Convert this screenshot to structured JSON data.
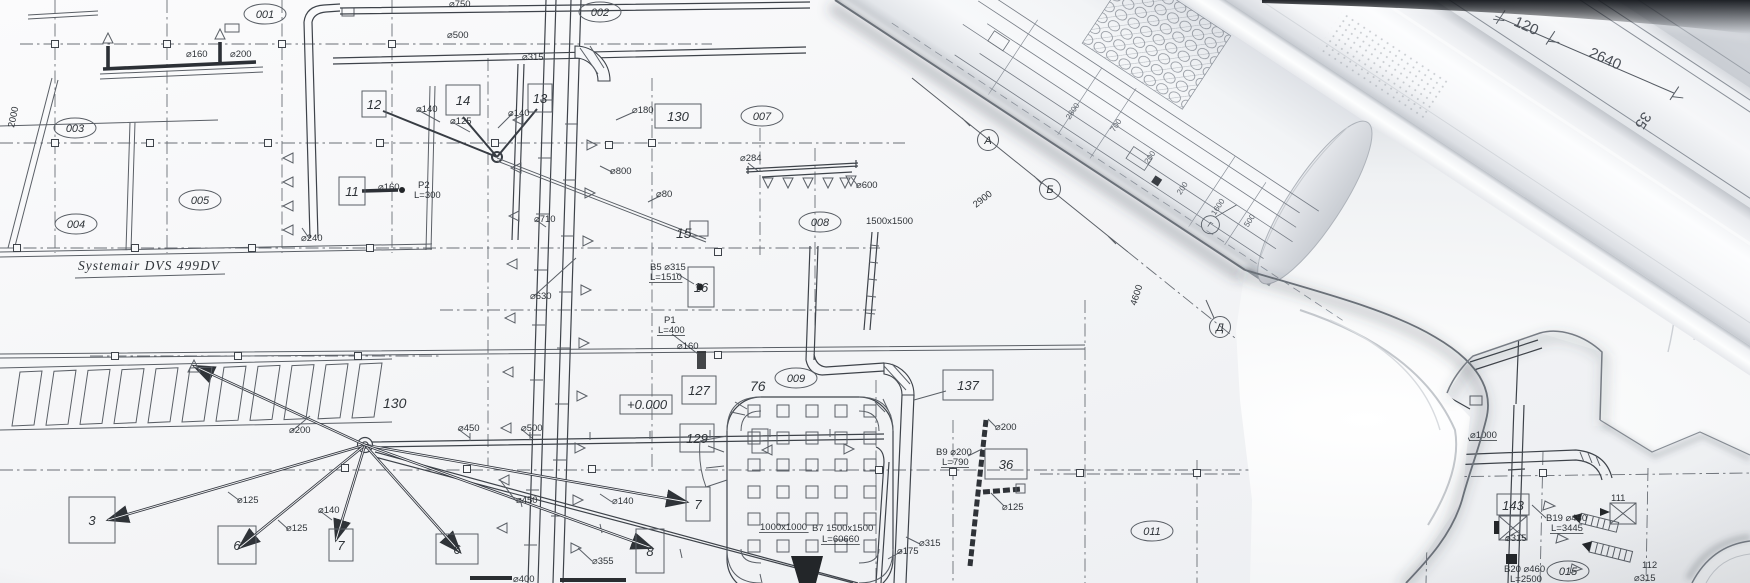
{
  "plan": {
    "title": "Systemair DVS 499DV",
    "elevation": "+0.000",
    "room_tags": [
      {
        "t": "001",
        "x": 265,
        "y": 14
      },
      {
        "t": "002",
        "x": 600,
        "y": 12
      },
      {
        "t": "003",
        "x": 75,
        "y": 128
      },
      {
        "t": "005",
        "x": 200,
        "y": 200
      },
      {
        "t": "004",
        "x": 76,
        "y": 224
      },
      {
        "t": "007",
        "x": 762,
        "y": 116
      },
      {
        "t": "008",
        "x": 820,
        "y": 222
      },
      {
        "t": "009",
        "x": 796,
        "y": 378
      },
      {
        "t": "011",
        "x": 1152,
        "y": 531
      }
    ],
    "equipment_boxes": [
      {
        "t": "12",
        "x": 374,
        "y": 104,
        "w": 24,
        "h": 26
      },
      {
        "t": "11",
        "x": 352,
        "y": 191,
        "w": 26,
        "h": 28
      },
      {
        "t": "14",
        "x": 463,
        "y": 100,
        "w": 34,
        "h": 30
      },
      {
        "t": "13",
        "x": 540,
        "y": 98,
        "w": 24,
        "h": 28
      },
      {
        "t": "130",
        "x": 678,
        "y": 116,
        "w": 46,
        "h": 24
      },
      {
        "t": "16",
        "x": 701,
        "y": 287,
        "w": 26,
        "h": 40
      },
      {
        "t": "127",
        "x": 699,
        "y": 390,
        "w": 34,
        "h": 28
      },
      {
        "t": "129",
        "x": 697,
        "y": 438,
        "w": 34,
        "h": 28
      },
      {
        "t": "137",
        "x": 968,
        "y": 385,
        "w": 50,
        "h": 30
      },
      {
        "t": "36",
        "x": 1006,
        "y": 464,
        "w": 42,
        "h": 30
      },
      {
        "t": "7",
        "x": 698,
        "y": 504,
        "w": 24,
        "h": 34
      },
      {
        "t": "3",
        "x": 92,
        "y": 520,
        "w": 46,
        "h": 46
      },
      {
        "t": "6",
        "x": 237,
        "y": 545,
        "w": 38,
        "h": 38
      },
      {
        "t": "7",
        "x": 341,
        "y": 545,
        "w": 24,
        "h": 32
      },
      {
        "t": "6",
        "x": 457,
        "y": 549,
        "w": 42,
        "h": 30
      },
      {
        "t": "8",
        "x": 650,
        "y": 551,
        "w": 28,
        "h": 44
      }
    ],
    "plain_tags": [
      {
        "t": "15",
        "x": 676,
        "y": 238
      },
      {
        "t": "76",
        "x": 750,
        "y": 391
      },
      {
        "t": "130",
        "x": 383,
        "y": 408
      }
    ],
    "dim_labels": [
      {
        "t": "⌀160",
        "x": 186,
        "y": 57
      },
      {
        "t": "⌀200",
        "x": 230,
        "y": 57
      },
      {
        "t": "⌀140",
        "x": 416,
        "y": 112
      },
      {
        "t": "⌀125",
        "x": 450,
        "y": 124
      },
      {
        "t": "⌀140",
        "x": 508,
        "y": 116
      },
      {
        "t": "⌀180",
        "x": 632,
        "y": 113
      },
      {
        "t": "⌀800",
        "x": 610,
        "y": 174
      },
      {
        "t": "⌀80",
        "x": 656,
        "y": 197
      },
      {
        "t": "⌀710",
        "x": 534,
        "y": 222
      },
      {
        "t": "⌀630",
        "x": 530,
        "y": 299
      },
      {
        "t": "⌀284",
        "x": 740,
        "y": 161
      },
      {
        "t": "⌀600",
        "x": 856,
        "y": 188
      },
      {
        "t": "⌀160",
        "x": 378,
        "y": 190
      },
      {
        "t": "⌀240",
        "x": 301,
        "y": 241
      },
      {
        "t": "⌀750",
        "x": 449,
        "y": 7
      },
      {
        "t": "⌀500",
        "x": 447,
        "y": 38
      },
      {
        "t": "⌀315",
        "x": 522,
        "y": 60
      },
      {
        "t": "⌀160",
        "x": 677,
        "y": 349
      },
      {
        "t": "⌀200",
        "x": 995,
        "y": 430
      },
      {
        "t": "⌀125",
        "x": 1002,
        "y": 510
      },
      {
        "t": "⌀175",
        "x": 897,
        "y": 554
      },
      {
        "t": "⌀450",
        "x": 458,
        "y": 431
      },
      {
        "t": "⌀500",
        "x": 521,
        "y": 431
      },
      {
        "t": "⌀450",
        "x": 516,
        "y": 503
      },
      {
        "t": "⌀140",
        "x": 612,
        "y": 504
      },
      {
        "t": "⌀355",
        "x": 592,
        "y": 564
      },
      {
        "t": "⌀400",
        "x": 513,
        "y": 582
      },
      {
        "t": "⌀200",
        "x": 289,
        "y": 433
      },
      {
        "t": "⌀125",
        "x": 237,
        "y": 503
      },
      {
        "t": "⌀125",
        "x": 286,
        "y": 531
      },
      {
        "t": "⌀140",
        "x": 318,
        "y": 513
      },
      {
        "t": "⌀315",
        "x": 919,
        "y": 546
      }
    ],
    "note_labels": [
      {
        "t": "B5 ⌀315",
        "x": 650,
        "y": 270
      },
      {
        "t": "L=1510",
        "x": 650,
        "y": 280,
        "u": 1
      },
      {
        "t": "P1",
        "x": 664,
        "y": 323
      },
      {
        "t": "L=400",
        "x": 658,
        "y": 333,
        "u": 1
      },
      {
        "t": "P2",
        "x": 418,
        "y": 188
      },
      {
        "t": "L=300",
        "x": 414,
        "y": 198
      },
      {
        "t": "B9 ⌀200",
        "x": 936,
        "y": 455
      },
      {
        "t": "L=790",
        "x": 942,
        "y": 465,
        "u": 1
      },
      {
        "t": "1000x1000",
        "x": 760,
        "y": 530,
        "u": 1
      },
      {
        "t": "B7 1500x1500",
        "x": 812,
        "y": 531
      },
      {
        "t": "L=60660",
        "x": 822,
        "y": 542,
        "u": 1
      },
      {
        "t": "1500x1500",
        "x": 866,
        "y": 224
      },
      {
        "t": "2900",
        "x": 976,
        "y": 208,
        "r": -38
      },
      {
        "t": "4600",
        "x": 1136,
        "y": 306,
        "r": -72
      },
      {
        "t": "2000",
        "x": 14,
        "y": 128,
        "r": -78
      }
    ],
    "axis_bubbles": [
      {
        "t": "A",
        "x": 988,
        "y": 140
      },
      {
        "t": "Б",
        "x": 1050,
        "y": 189
      },
      {
        "t": "Д",
        "x": 1220,
        "y": 327
      }
    ]
  },
  "corner_drawing": {
    "dim_labels": [
      {
        "t": "⌀1000",
        "x": 1470,
        "y": 438,
        "u": 1,
        "fs": 11
      },
      {
        "t": "⌀315",
        "x": 1505,
        "y": 541
      },
      {
        "t": "B19 ⌀450",
        "x": 1546,
        "y": 521
      },
      {
        "t": "L=3445",
        "x": 1551,
        "y": 531,
        "u": 1
      },
      {
        "t": "111",
        "x": 1611,
        "y": 501,
        "fs": 12
      },
      {
        "t": "112",
        "x": 1642,
        "y": 568,
        "fs": 12
      },
      {
        "t": "⌀315",
        "x": 1634,
        "y": 581
      },
      {
        "t": "B20 ⌀460",
        "x": 1504,
        "y": 572
      },
      {
        "t": "L=2500",
        "x": 1510,
        "y": 582,
        "u": 1
      }
    ],
    "equipment_box": {
      "t": "143"
    },
    "room_tag": {
      "t": "015"
    }
  },
  "rolls": {
    "dim_labels": [
      {
        "t": "120",
        "x": 592,
        "y": 76,
        "r": -9
      },
      {
        "t": "2640",
        "x": 676,
        "y": 60,
        "r": -9
      },
      {
        "t": "35",
        "x": 736,
        "y": 86,
        "r": 90
      }
    ],
    "fragment_labels": [
      {
        "t": "700",
        "x": 306,
        "y": 140
      },
      {
        "t": "200",
        "x": 352,
        "y": 148
      },
      {
        "t": "2800",
        "x": 262,
        "y": 152
      },
      {
        "t": "200",
        "x": 396,
        "y": 156
      },
      {
        "t": "1600",
        "x": 436,
        "y": 152
      },
      {
        "t": "500",
        "x": 470,
        "y": 146
      }
    ],
    "axis_bubble": {
      "t": "Г",
      "x": 437,
      "y": 171
    }
  }
}
